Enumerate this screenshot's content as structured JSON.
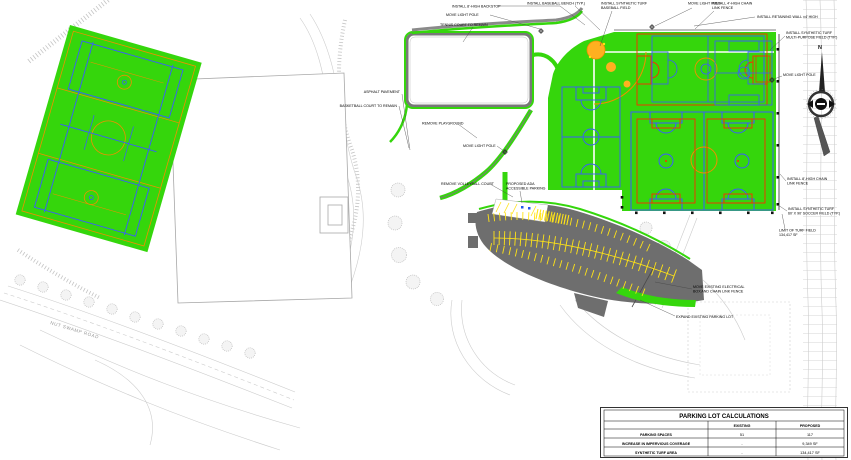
{
  "colors": {
    "turf_green": "#35d60c",
    "court_blue": "#3b5bff",
    "marking_red": "#ff2a00",
    "marking_orange": "#f08f00",
    "infield_orange": "#ffb020",
    "pavement_gray": "#6e6e6e",
    "stripe_yellow": "#ffe317",
    "contour_gray": "#cccccc"
  },
  "labels": {
    "backstop": "INSTALL 8'-HIGH BACKSTOP",
    "move_light_pole": "MOVE LIGHT POLE",
    "tennis_remain": "TENNIS COURT TO REMAIN",
    "baseball_bench": "INSTALL BASEBALL BENCH (TYP.)",
    "turf_baseball_1": "INSTALL SYNTHETIC TURF",
    "turf_baseball_2": "BASEBALL FIELD",
    "chain4_1": "INSTALL 4'-HIGH CHAIN",
    "chain4_2": "LINK FENCE",
    "retaining_wall": "INSTALL RETAINING WALL ±4' HIGH",
    "multi_1": "INSTALL SYNTHETIC TURF",
    "multi_2": "MULTI-PURPOSE FIELD (TYP.)",
    "chain8_1": "INSTALL 8'-HIGH CHAIN",
    "chain8_2": "LINK FENCE",
    "soccer_1": "INSTALL SYNTHETIC TURF",
    "soccer_2": "60' X 90' SOCCER FIELD (TYP.)",
    "limit_1": "LIMIT OF TURF FIELD",
    "limit_2": "134,417 SF",
    "asphalt": "ASPHALT PAVEMENT",
    "basketball_remain": "BASKETBALL COURT TO REMAIN",
    "remove_playground": "REMOVE PLAYGROUND",
    "remove_volleyball": "REMOVE VOLLEYBALL COURT",
    "ada_1": "PROPOSED ADA",
    "ada_2": "ACCESSIBLE PARKING",
    "electrical_1": "MOVE EXISTING ELECTRICAL",
    "electrical_2": "BOX AND CHAIN LINK FENCE",
    "expand_parking": "EXPAND EXISTING PARKING LOT",
    "road": "NUT SWAMP ROAD",
    "north": "N"
  },
  "table": {
    "title": "PARKING LOT CALCULATIONS",
    "col_existing": "EXISTING",
    "col_proposed": "PROPOSED",
    "rows": [
      {
        "label": "PARKING SPACES",
        "existing": "51",
        "proposed": "117"
      },
      {
        "label": "INCREASE IN IMPERVIOUS COVERAGE",
        "existing": "-",
        "proposed": "9,349 SF"
      },
      {
        "label": "SYNTHETIC TURF AREA",
        "existing": "-",
        "proposed": "134,417 SF"
      }
    ]
  }
}
